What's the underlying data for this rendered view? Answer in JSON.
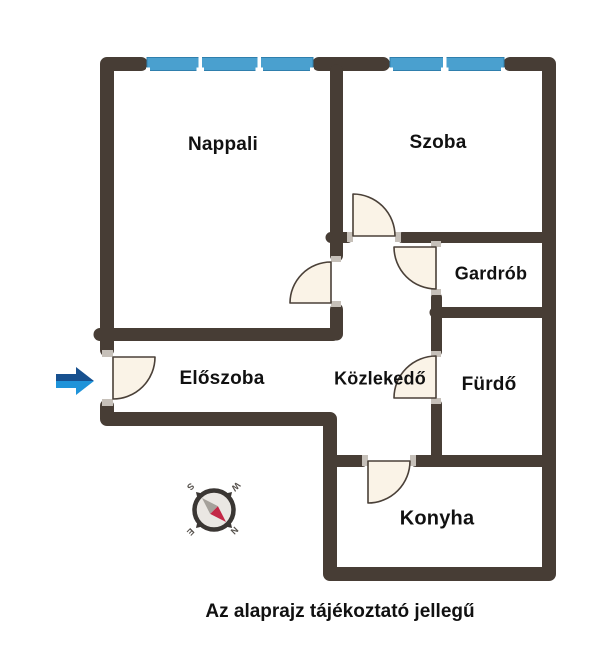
{
  "floor_plan": {
    "rooms": {
      "nappali": "Nappali",
      "szoba": "Szoba",
      "gardrob": "Gardrób",
      "eloszoba": "Előszoba",
      "kozlekedo": "Közlekedő",
      "furdo": "Fürdő",
      "konyha": "Konyha"
    },
    "caption": "Az alaprajz tájékoztató jellegű",
    "compass": {
      "north": "N",
      "east": "E",
      "south": "S",
      "west": "W"
    },
    "entrance": {
      "symbol": "blue-arrow-right"
    },
    "colors": {
      "wall": "#473D35",
      "window_fill": "#4AA0CF",
      "window_border": "#2F7FAD",
      "window_divider": "#FFFFFF",
      "door_fill": "#FAF3E7",
      "door_stroke": "#4A4038",
      "hinge_mark": "#C6C0B9",
      "arrow_dark_blue": "#17508F",
      "arrow_light_blue": "#1F93D9",
      "compass_ring": "#3A3633",
      "compass_face": "#EAE7E3",
      "needle_red": "#C32847",
      "needle_gray": "#A5A19B",
      "label_text": "#111111"
    }
  }
}
